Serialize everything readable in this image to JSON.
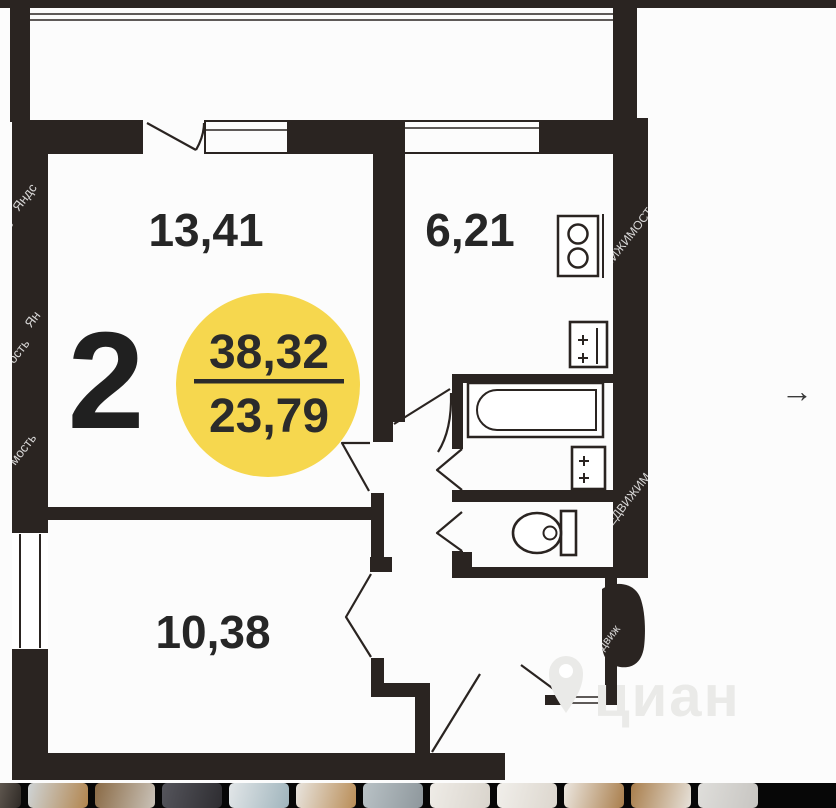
{
  "page": {
    "background": "#fcfcfc",
    "top_bar_color": "#2a2421"
  },
  "floor_plan": {
    "wall_color": "#2a2421",
    "rooms_badge": "2",
    "area_total": "38,32",
    "area_living": "23,79",
    "badge_color": "#f6d74e",
    "living_room_area": "13,41",
    "kitchen_area": "6,21",
    "bedroom_area": "10,38",
    "icons": [
      "stove-icon",
      "kitchen-sink-icon",
      "bathtub-icon",
      "bathroom-sink-icon",
      "toilet-icon",
      "location-pin-icon",
      "next-arrow-icon"
    ]
  },
  "watermarks": {
    "left_fragments": [
      "Яндс",
      "сть",
      "Ян",
      "ость",
      "мость"
    ],
    "right_fragments": [
      "ДВИЖИМОСТ",
      "НЕДВИЖИМ",
      "движ"
    ],
    "brand": "циан",
    "brand_color": "#eaeae8"
  },
  "carousel": {
    "next_arrow": "→"
  },
  "gallery": {
    "thumbnails": [
      {
        "w": 21,
        "c1": "#5e564e",
        "c2": "#2f2a26"
      },
      {
        "c1": "#cfd4d6",
        "c2": "#b2854e"
      },
      {
        "c1": "#8a6a45",
        "c2": "#c9c2b8"
      },
      {
        "c1": "#55555c",
        "c2": "#2e2d31"
      },
      {
        "c1": "#e2e6e8",
        "c2": "#9fb4bc"
      },
      {
        "c1": "#e8e4de",
        "c2": "#b98d57"
      },
      {
        "c1": "#b9c2c6",
        "c2": "#8e979c"
      },
      {
        "c1": "#efece7",
        "c2": "#d9d4cc"
      },
      {
        "c1": "#f1efeb",
        "c2": "#dcd6cd"
      },
      {
        "c1": "#ece7e0",
        "c2": "#a97e4c"
      },
      {
        "c1": "#a97e4c",
        "c2": "#e6e1d9"
      },
      {
        "c1": "#dfdedb",
        "c2": "#c7c5c1"
      }
    ]
  }
}
